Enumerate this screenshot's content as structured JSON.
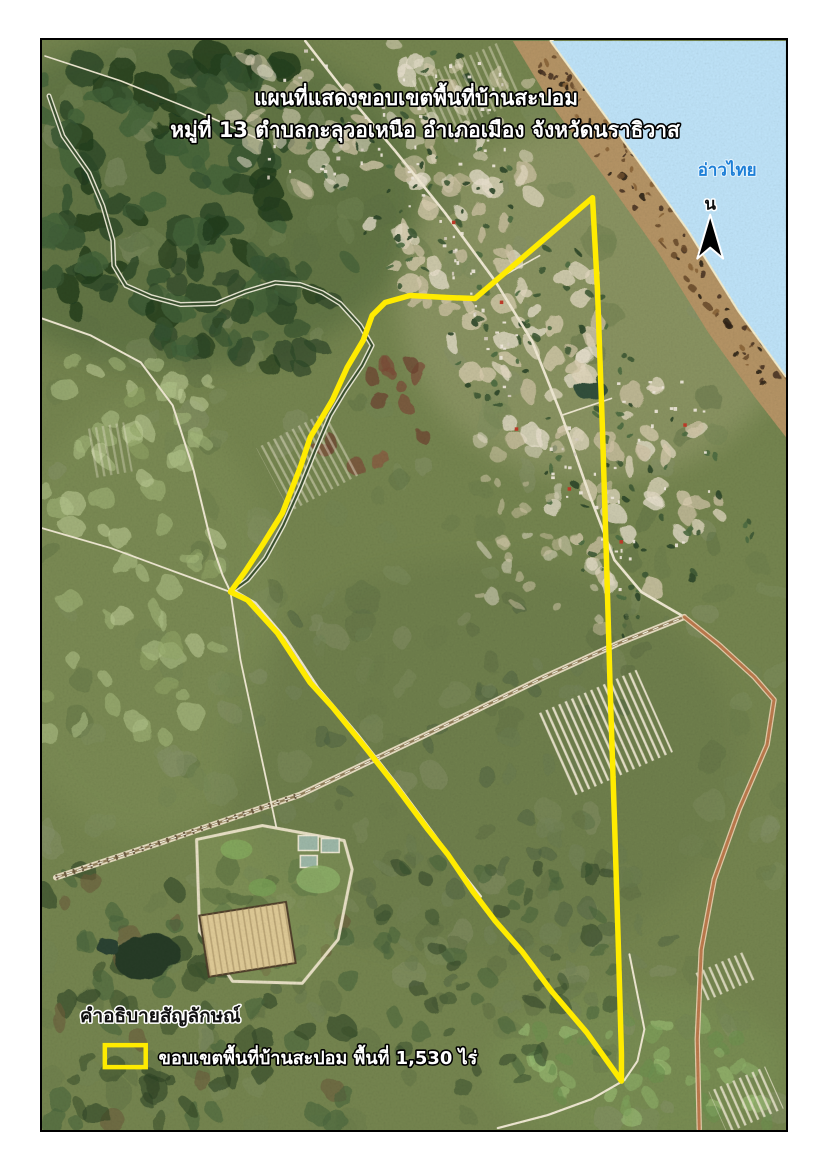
{
  "map": {
    "title_line1": "แผนที่แสดงขอบเขตพื้นที่บ้านสะปอม",
    "title_line2": "หมู่ที่ 13  ตำบลกะลุวอเหนือ อำเภอเมือง จังหวัดนราธิวาส",
    "sea_label": "อ่าวไทย",
    "north_label": "น"
  },
  "legend": {
    "heading": "คำอธิบายสัญลักษณ์",
    "item_label": "ขอบเขตพื้นที่บ้านสะปอม พื้นที่ 1,530 ไร่"
  },
  "colors": {
    "boundary": "#ffeb00",
    "sea": "#bfe4f9",
    "sand_line": "#f6eecd",
    "beach": "#b59465",
    "land_base": "#6e7f4d",
    "road": "#f1ead4",
    "red_road": "#bd7a4d",
    "river_water": "#3a512f",
    "sea_label_color": "#1e7fd6",
    "north_arrow": "#000000"
  },
  "geometry": {
    "frame": {
      "x": 41,
      "y": 39,
      "w": 746,
      "h": 1092
    },
    "boundary_points": "593,197 598,290 603,430 607,560 611,700 615,820 619,950 622,1055 622,1082 607,1061 587,1033 552,992 523,953 495,921 473,892 448,855 428,830 393,783 367,750 332,707 310,683 277,633 247,600 230,592 245,571 262,545 282,513 300,467 310,437 332,400 347,367 363,340 372,315 385,302 410,295 447,297 475,298 593,197",
    "coastline": "552,40 585,85 640,160 690,230 740,310 787,375",
    "sea": "552,40 585,85 640,160 690,230 740,310 787,375 787,40",
    "beach": "552,40 585,85 640,160 690,230 740,310 787,375 787,437 756,397 709,332 659,252 609,182 554,107 513,40",
    "river": "48,95 62,135 88,172 102,205 112,240 113,265 125,285 150,296 180,304 215,303 245,291 275,282 300,284 322,292 340,303 360,325 372,345 362,365 345,390 330,415 315,450 300,487 283,525 265,558 247,580 233,590",
    "canal_lower": "233,590 255,603 285,638 318,688 358,735 398,786 433,833 466,878 481,897",
    "railway": "55,878 160,843 300,795 430,733 545,677 620,643 685,617",
    "railway_ties": "55,878 160,843 300,795",
    "roads": [
      {
        "name": "coastal-road",
        "pts": "305,40 340,85 395,150 445,212 495,280 532,340 562,415 590,495 615,560 642,592 685,617",
        "w": 2.6,
        "red": false
      },
      {
        "name": "south-red-road",
        "pts": "685,617 720,645 755,677 775,700 768,745 740,810 715,880 702,950 698,1040 700,1130",
        "w": 3,
        "red": true
      },
      {
        "name": "nw-road",
        "pts": "41,318 90,335 140,362 172,405 193,470 210,540 222,575 230,592",
        "w": 2,
        "red": false
      },
      {
        "name": "west-road",
        "pts": "230,592 175,572 110,548 41,528",
        "w": 1.8,
        "red": false
      },
      {
        "name": "south-road",
        "pts": "230,592 240,660 255,730 268,790 276,828",
        "w": 1.8,
        "red": false
      },
      {
        "name": "tip-west-road",
        "pts": "625,1081 592,1100 548,1116 498,1129",
        "w": 2.2,
        "red": false
      },
      {
        "name": "tip-north-road",
        "pts": "630,955 645,1030 638,1062 625,1081",
        "w": 2,
        "red": false
      },
      {
        "name": "forest-edge-road",
        "pts": "44,55 120,80 200,112 262,140",
        "w": 1.6,
        "red": false
      },
      {
        "name": "beach-spur-1",
        "pts": "495,280 540,255",
        "w": 1.6,
        "red": false
      },
      {
        "name": "beach-spur-2",
        "pts": "562,415 612,398",
        "w": 1.6,
        "red": false
      }
    ],
    "north_arrow": {
      "cx": 711,
      "tip_y": 214,
      "base_y": 258,
      "half_w": 13,
      "notch_y": 247
    },
    "labels": {
      "title1": {
        "x": 416,
        "y": 104,
        "size": 21
      },
      "title2": {
        "x": 425,
        "y": 136,
        "size": 21
      },
      "sea": {
        "x": 728,
        "y": 175,
        "size": 17
      },
      "north": {
        "x": 711,
        "y": 209,
        "size": 17
      },
      "legend_heading": {
        "x": 79,
        "y": 1023,
        "size": 19
      },
      "legend_item": {
        "x": 158,
        "y": 1065,
        "size": 18
      },
      "legend_swatch": {
        "x": 104,
        "y": 1046,
        "w": 41,
        "h": 22
      }
    }
  }
}
